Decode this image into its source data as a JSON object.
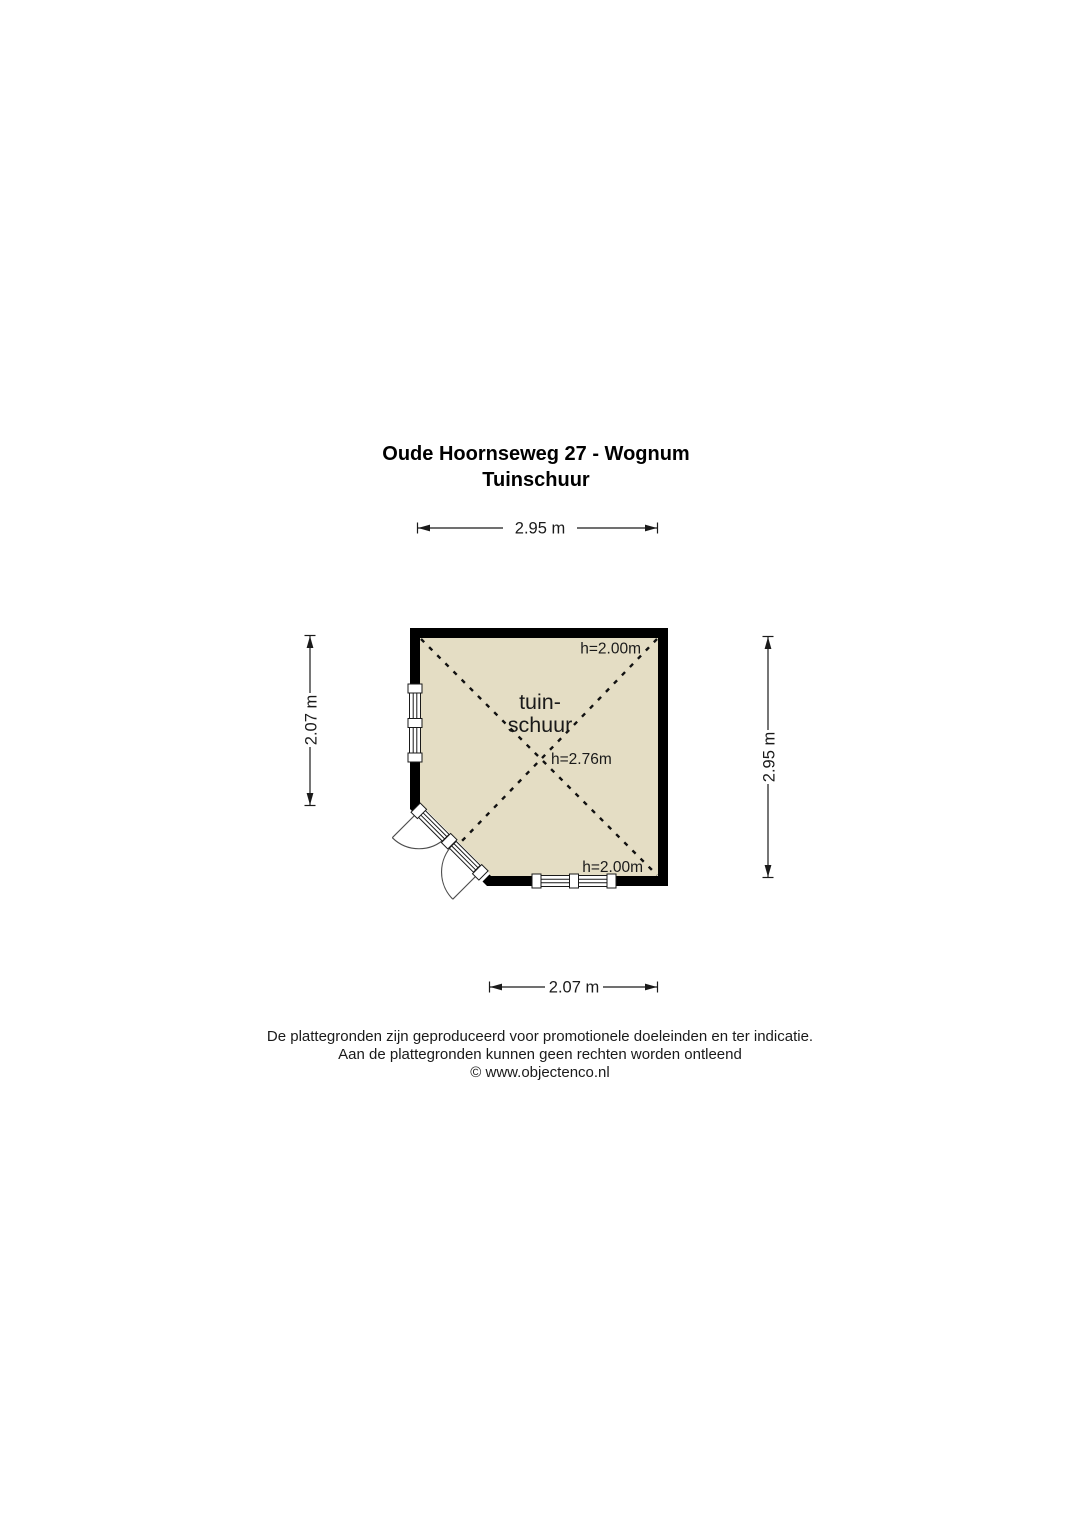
{
  "title": {
    "line1": "Oude Hoornseweg 27 - Wognum",
    "line2": "Tuinschuur"
  },
  "dimensions": {
    "top": "2.95 m",
    "left": "2.07 m",
    "right": "2.95 m",
    "bottom": "2.07 m"
  },
  "floorplan": {
    "room_name_line1": "tuin-",
    "room_name_line2": "schuur",
    "ceiling_height_top": "h=2.00m",
    "ceiling_height_center": "h=2.76m",
    "ceiling_height_bottom": "h=2.00m",
    "colors": {
      "wall": "#000000",
      "floor": "#e4ddc4",
      "door_line": "#4d4d4d",
      "background": "#ffffff"
    }
  },
  "footer": {
    "line1": "De plattegronden zijn geproduceerd voor promotionele doeleinden en ter indicatie.",
    "line2": "Aan de plattegronden kunnen geen rechten worden ontleend",
    "line3": "© www.objectenco.nl"
  }
}
